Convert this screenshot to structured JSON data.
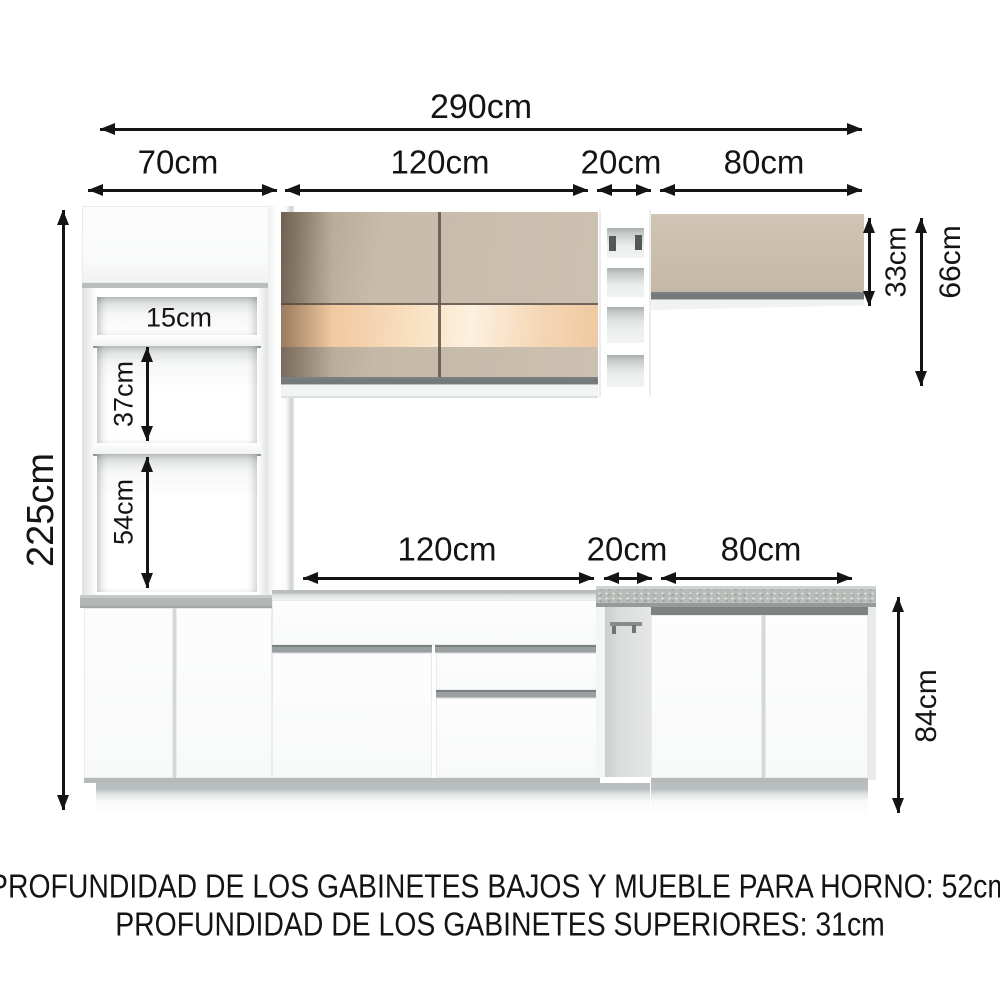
{
  "dimensions": {
    "total_width": "290cm",
    "segments_top": [
      "70cm",
      "120cm",
      "20cm",
      "80cm"
    ],
    "segments_counter": [
      "120cm",
      "20cm",
      "80cm"
    ],
    "total_height": "225cm",
    "tower_openings": [
      "15cm",
      "37cm",
      "54cm"
    ],
    "wall_cabinet_height": "33cm",
    "wall_section_height": "66cm",
    "base_height": "84cm"
  },
  "notes": {
    "line1": "PROFUNDIDAD DE LOS GABINETES BAJOS Y MUEBLE PARA HORNO: 52cm",
    "line2": "PROFUNDIDAD DE LOS GABINETES SUPERIORES: 31cm"
  },
  "colors": {
    "beige_door": "#c9bdac",
    "copper_glass_band": "#f6d9b8",
    "countertop_gray": "#b4b9b7",
    "handle_strip_gray": "#83888a",
    "dimension_line_black": "#141414",
    "cabinet_white": "#fbfcfc"
  }
}
